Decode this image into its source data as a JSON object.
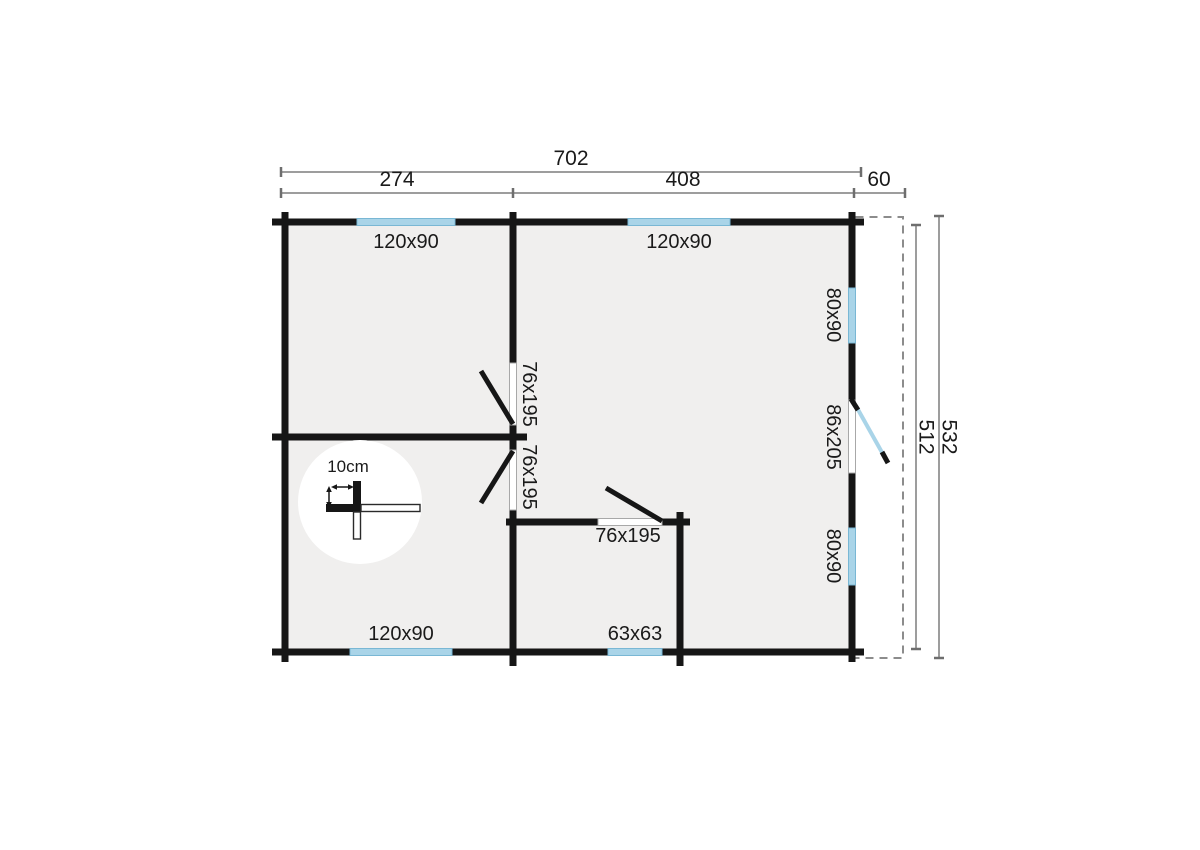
{
  "plan": {
    "title": "log-cabin-floor-plan",
    "dimensions_top": {
      "overall": "702",
      "segment_left": "274",
      "segment_right": "408",
      "overhang": "60"
    },
    "dimensions_right": {
      "inner": "512",
      "outer": "532"
    },
    "windows": {
      "top_left": "120x90",
      "top_right": "120x90",
      "bottom_left": "120x90",
      "bottom_small": "63x63",
      "right_upper": "80x90",
      "right_lower": "80x90"
    },
    "doors": {
      "interior_upper": "76x195",
      "interior_lower": "76x195",
      "interior_bottom": "76x195",
      "entrance": "86x205"
    },
    "scale": {
      "label": "10cm"
    },
    "colors": {
      "wall": "#161616",
      "room_fill": "#f0efee",
      "window_blue": "#a9d4e8",
      "glazed_door": "#a9d4e8",
      "dimension_line": "#7d7d7d",
      "dashed_outline": "#8c8c8c"
    }
  }
}
